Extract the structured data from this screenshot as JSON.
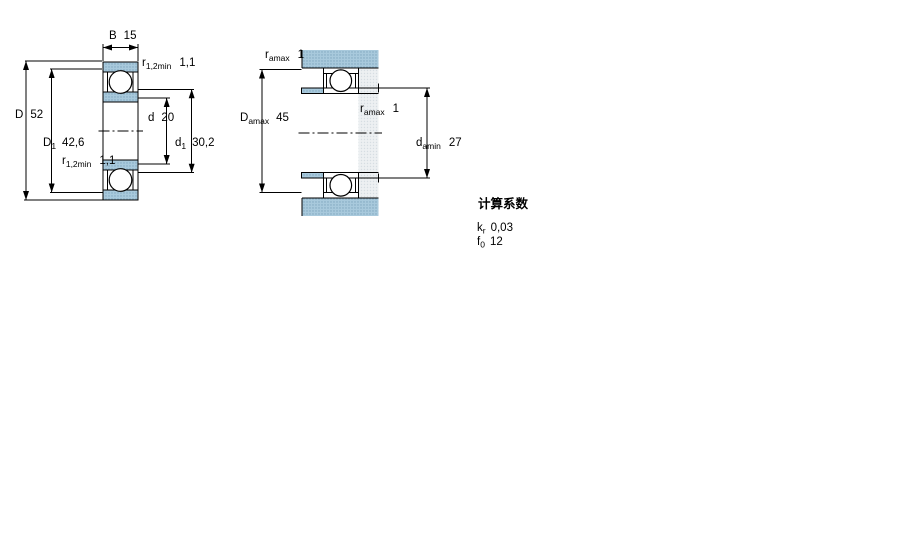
{
  "figure": {
    "kind": "bearing-dimension-drawing",
    "views": [
      "front-section-view",
      "mounted-abutment-view"
    ]
  },
  "front_view": {
    "width": {
      "symbol": "B",
      "value": "15"
    },
    "chamfer_top": {
      "symbol": "r",
      "sub": "1,2min",
      "value": "1,1"
    },
    "outer_diameter": {
      "symbol": "D",
      "value": "52"
    },
    "outer_ring_inner_diameter": {
      "symbol": "D",
      "sub": "1",
      "value": "42,6"
    },
    "chamfer_bottom": {
      "symbol": "r",
      "sub": "1,2min",
      "value": "1,1"
    },
    "bore_diameter": {
      "symbol": "d",
      "value": "20"
    },
    "inner_ring_outer_diameter": {
      "symbol": "d",
      "sub": "1",
      "value": "30,2"
    }
  },
  "mounted_view": {
    "fillet_top": {
      "symbol": "r",
      "sub": "amax",
      "value": "1"
    },
    "housing_shoulder_diameter": {
      "symbol": "D",
      "sub": "amax",
      "value": "45"
    },
    "fillet_mid": {
      "symbol": "r",
      "sub": "amax",
      "value": "1"
    },
    "shaft_shoulder_diameter": {
      "symbol": "d",
      "sub": "amin",
      "value": "27"
    }
  },
  "calculation_factors": {
    "heading": "计算系数",
    "kr": {
      "symbol": "k",
      "sub": "r",
      "value": "0,03"
    },
    "f0": {
      "symbol": "f",
      "sub": "0",
      "value": "12"
    }
  },
  "colors": {
    "section_fill": "#a8c9dc",
    "section_dot": "#7fa6be",
    "shaft_fill": "#edf0f2",
    "shaft_dot": "#d6dde2",
    "line": "#000000",
    "background": "#ffffff"
  }
}
